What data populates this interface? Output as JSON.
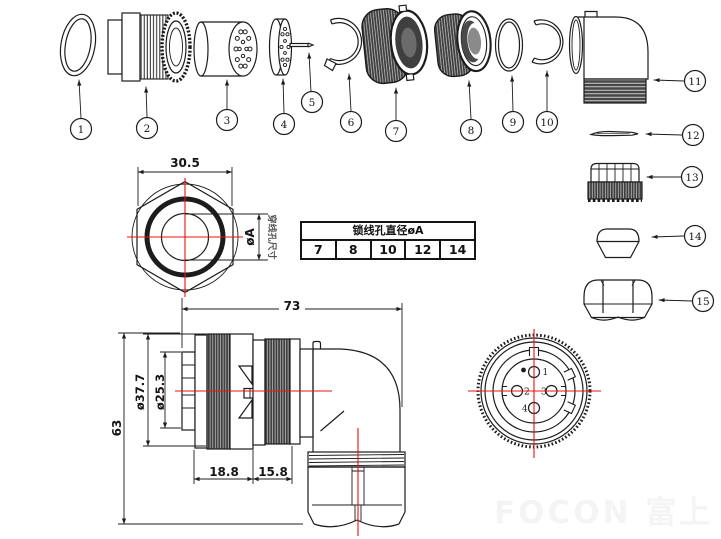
{
  "colors": {
    "line": "#1c1c1c",
    "centerline": "#ee1111",
    "knurl_fill": "#3f3f3f"
  },
  "exploded_parts": {
    "numbers": [
      "1",
      "2",
      "3",
      "4",
      "5",
      "6",
      "7",
      "8",
      "9",
      "10",
      "11",
      "12",
      "13",
      "14",
      "15"
    ]
  },
  "spec_table": {
    "title": "锁线孔直径øA",
    "values": [
      "7",
      "8",
      "10",
      "12",
      "14"
    ]
  },
  "hex_view": {
    "width_dim": "30.5",
    "hole_dim": "øA",
    "hole_note": "穿线孔尺寸"
  },
  "side_view": {
    "length_dim": "73",
    "outer_dia_dim": "ø37.7",
    "inner_dia_dim": "ø25.3",
    "height_dim": "63",
    "front_len_dim": "18.8",
    "rear_len_dim": "15.8"
  },
  "face_view": {
    "pin_labels": [
      "1",
      "2",
      "3",
      "4"
    ]
  },
  "watermark": "FOCON 富上"
}
